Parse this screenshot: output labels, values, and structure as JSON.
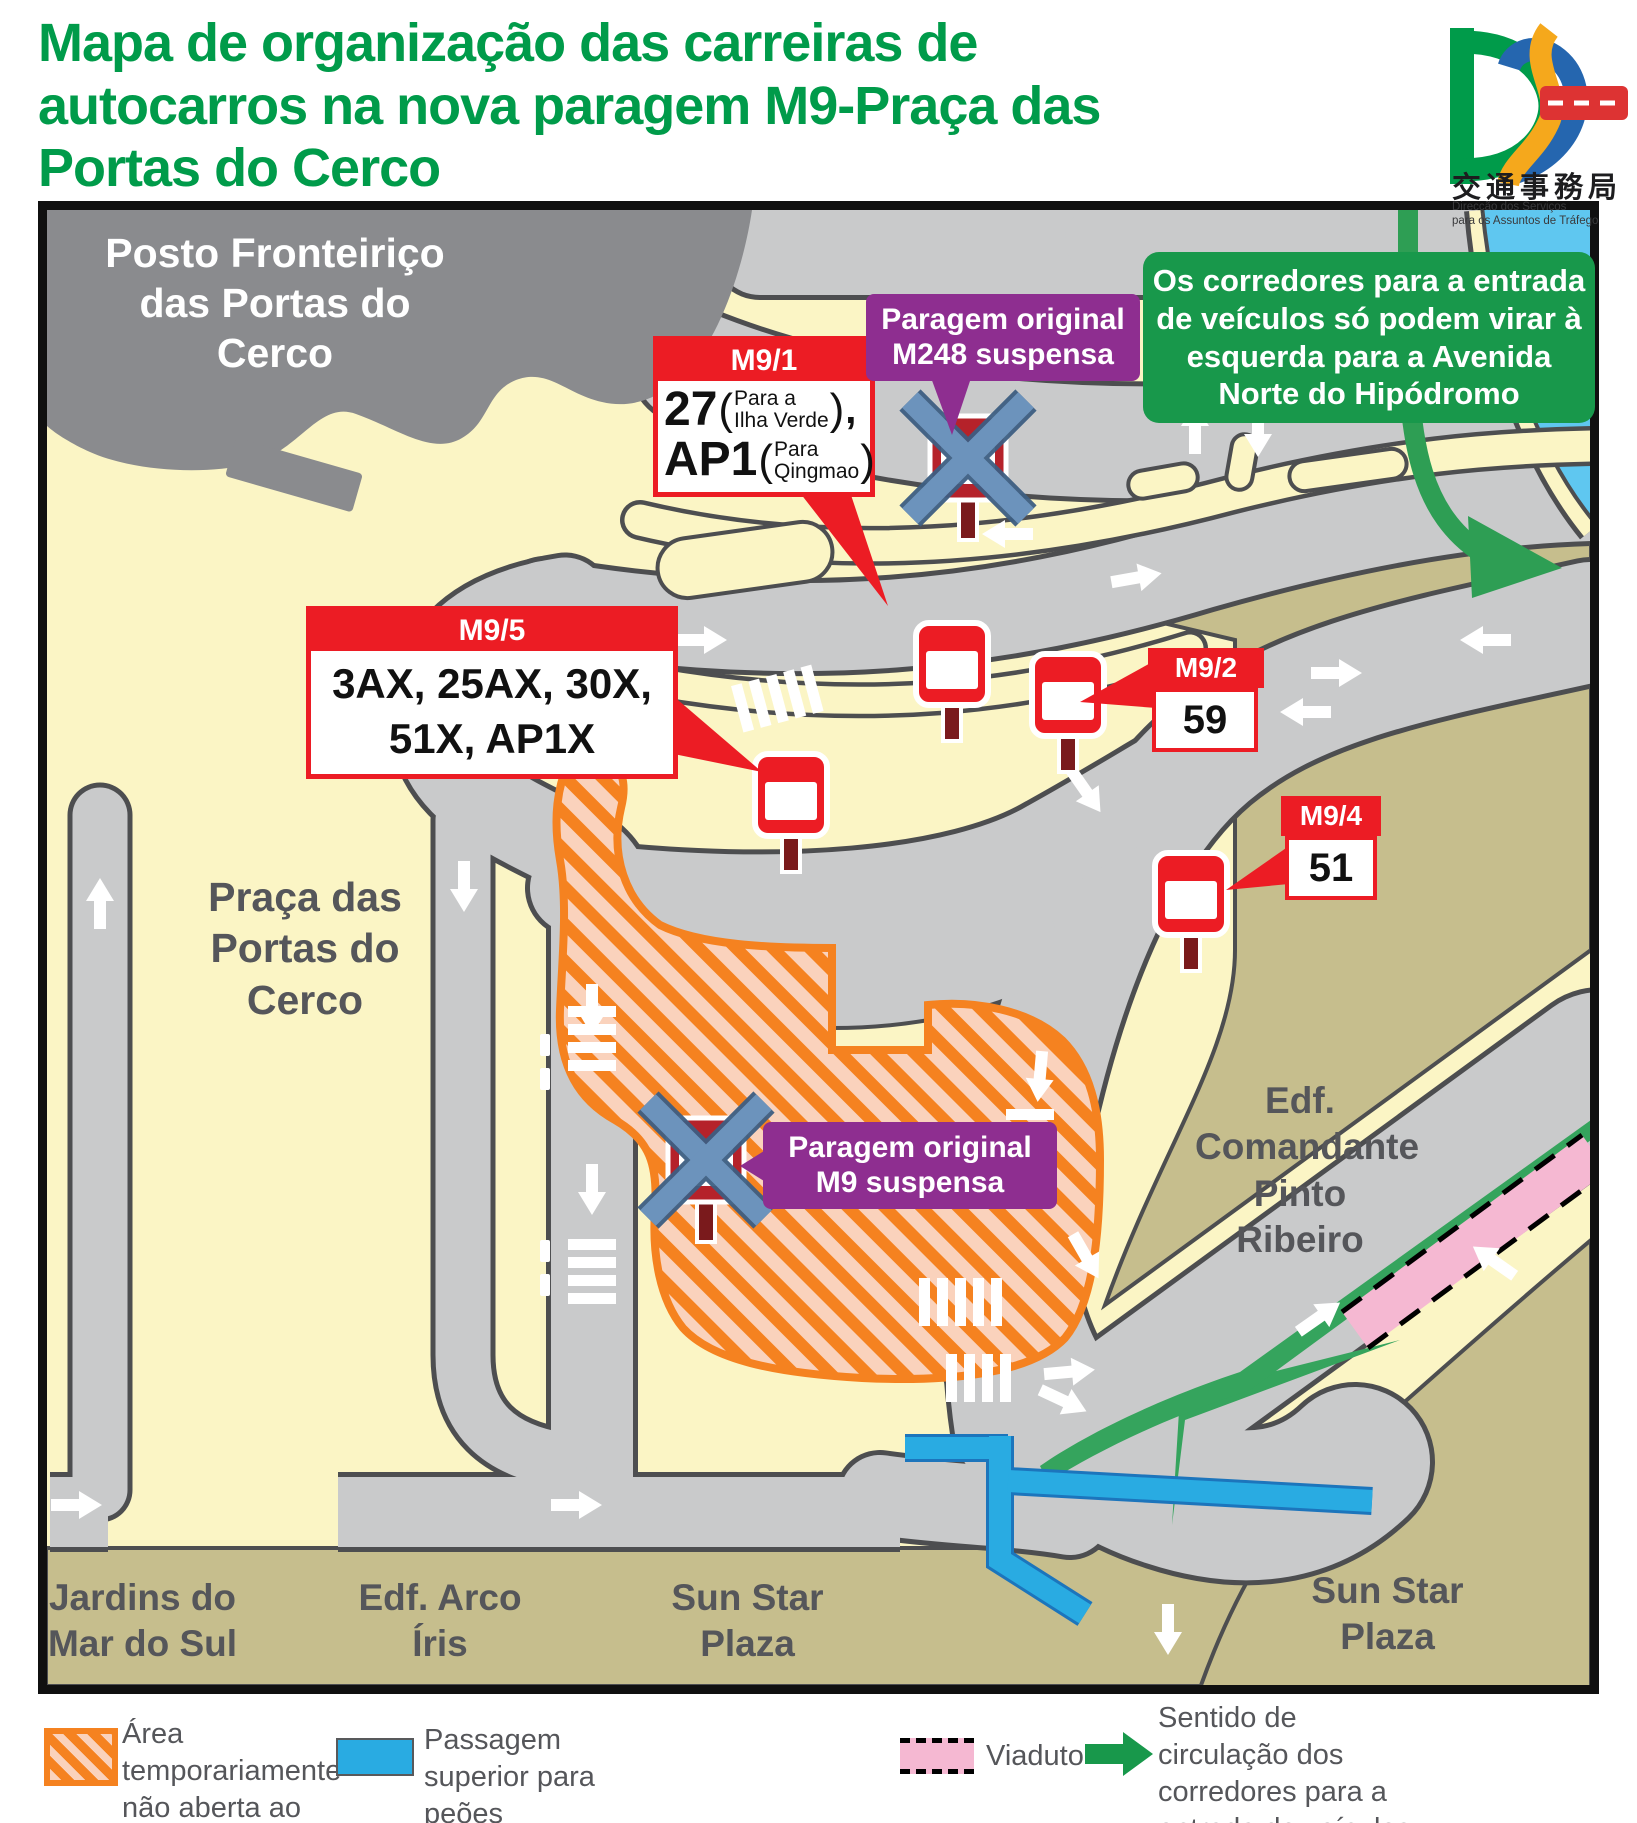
{
  "title": "Mapa de organização das carreiras de autocarros na nova paragem M9-Praça das Portas do Cerco",
  "logo": {
    "org_zh": "交通事務局",
    "org_pt_line1": "Direcção dos Serviços",
    "org_pt_line2": "para os Assuntos de Tráfego"
  },
  "map": {
    "areas": {
      "frontier": "Posto Fronteiriço das Portas do Cerco",
      "plaza": "Praça das Portas do Cerco",
      "building_right": "Edf. Comandante Pinto Ribeiro",
      "bottom_left": "Jardins do Mar do Sul",
      "bottom_mid": "Edf. Arco Íris",
      "bottom_center": "Sun Star Plaza",
      "bottom_right": "Sun Star Plaza"
    },
    "callouts": {
      "m91": {
        "id": "M9/1",
        "route1_number": "27",
        "route1_dest_line1": "Para a",
        "route1_dest_line2": "Ilha Verde",
        "separator": ",",
        "route2_number": "AP1",
        "route2_dest_line1": "Para",
        "route2_dest_line2": "Qingmao",
        "paren_open": "(",
        "paren_close": ")"
      },
      "m95": {
        "id": "M9/5",
        "routes_line1": "3AX, 25AX, 30X,",
        "routes_line2": "51X, AP1X"
      },
      "m92": {
        "id": "M9/2",
        "route": "59"
      },
      "m94": {
        "id": "M9/4",
        "route": "51"
      },
      "m248_note": "Paragem original M248 suspensa",
      "m9_note": "Paragem original M9 suspensa",
      "corridor_note": "Os corredores para a entrada de veículos só podem virar à esquerda para a Avenida Norte do Hipódromo"
    }
  },
  "legend": {
    "items": [
      {
        "key": "closed-area",
        "label": "Área temporariamente não aberta ao público"
      },
      {
        "key": "pedestrian-overpass",
        "label": "Passagem superior para peões"
      },
      {
        "key": "viaduct",
        "label": "Viaduto"
      },
      {
        "key": "entry-corridor-direction",
        "label": "Sentido de circulação dos corredores para a entrada de veículos"
      }
    ]
  },
  "colors": {
    "title_green": "#009B4A",
    "map_yellow": "#FBF5C5",
    "road_gray": "#C9CACB",
    "road_outline": "#4D4E50",
    "frontier_gray": "#8A8B8E",
    "building_olive": "#C6BE8D",
    "water_blue": "#5FC7F0",
    "closed_orange": "#F58220",
    "label_red": "#EC1C24",
    "note_purple": "#8E2E90",
    "note_green": "#18984B",
    "overpass_blue": "#29ABE2",
    "viaduct_pink": "#F5B8D2"
  }
}
